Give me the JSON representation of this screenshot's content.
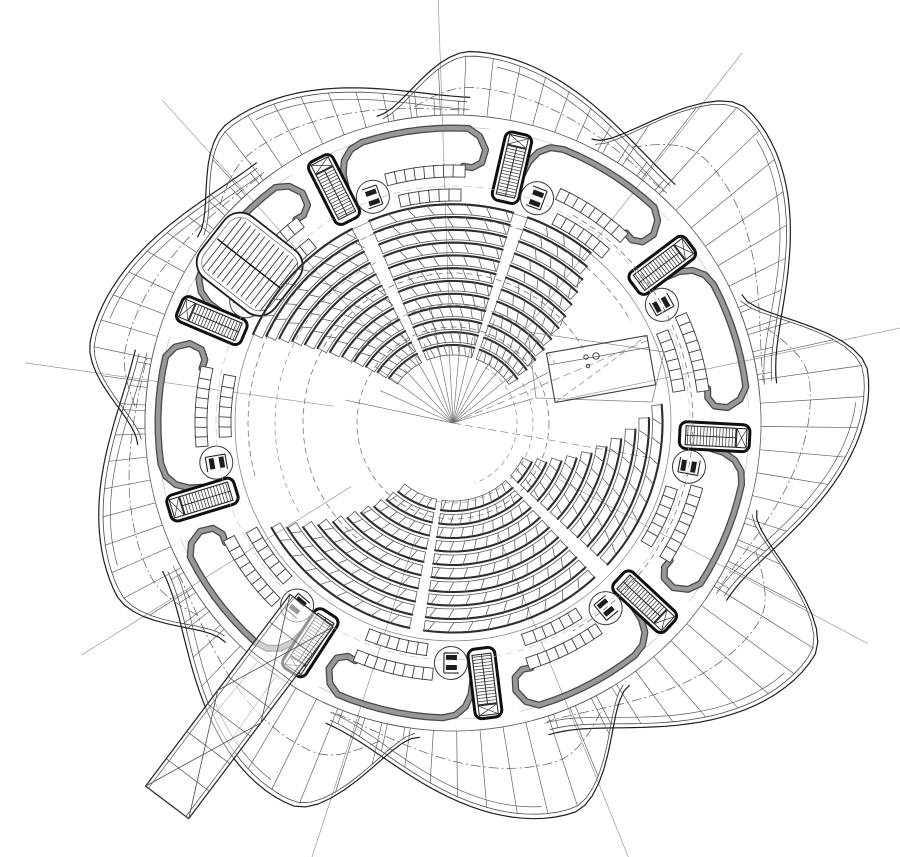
{
  "meta": {
    "title": "Circular auditorium floor plan",
    "description": "Nine-segment radial auditorium plan: petal envelope, perimeter stair cores, lift circles, corridor walls, spiral seating banks, rostrum, main stair and entry ramp"
  },
  "canvas": {
    "width": 900,
    "height": 857,
    "background": "#ffffff"
  },
  "colors": {
    "ink": "#1f1f1f",
    "medium": "#4a4a4a",
    "line": "#5a5a5a",
    "light": "#9a9a9a",
    "faint": "#b9b9b9",
    "wall_fill": "#989898",
    "wall_edge": "#4a4a4a",
    "seat_heavy": "#2d2d2d",
    "white": "#ffffff"
  },
  "plan": {
    "center": {
      "x": 453,
      "y": 423
    },
    "segments": 9,
    "base_angle_deg": 3,
    "step_deg": 40,
    "inner_ring_r": 308,
    "corridor_arc_r": 296,
    "floor_circle_r": 218,
    "petal": {
      "rise_start_deg": -27,
      "apex_deg": -10,
      "fall_end_deg": 30,
      "base_r": 316,
      "end_r": 326,
      "apex_r": [
        418,
        430,
        408,
        415,
        378,
        372,
        375,
        372,
        430
      ],
      "panel_step_deg": 4.33,
      "double_offset": 4.5
    },
    "wall": {
      "arc_r": 295,
      "arc_start_deg": 9,
      "arc_end_deg": 30,
      "stub": [
        [
          2.5,
          256
        ],
        [
          3.2,
          272
        ],
        [
          4.5,
          284
        ],
        [
          6.5,
          292
        ]
      ],
      "hook": [
        [
          32.3,
          288
        ],
        [
          33.8,
          275
        ],
        [
          33.3,
          262
        ],
        [
          31.3,
          256
        ],
        [
          29.3,
          257
        ]
      ],
      "outer_w": 7,
      "inner_w": 4.4
    },
    "core": {
      "r": 262,
      "len": 70,
      "wid": 27
    },
    "lift": {
      "angle_offset_deg": 7.5,
      "r": 240,
      "radius": 16.5
    },
    "gallery": [
      {
        "r": 252,
        "from_deg": 13,
        "to_deg": 29,
        "step_deg": 2.2,
        "size": 12
      },
      {
        "r": 228,
        "from_deg": 15,
        "to_deg": 27.5,
        "step_deg": 2.5,
        "size": 12
      }
    ],
    "boundary_line": {
      "angle_offset_deg": -15,
      "r0": 120,
      "r1": 470
    }
  },
  "stair_main": {
    "angle_deg": 218,
    "r": 258,
    "length": 94,
    "width": 78,
    "tread_step": 6
  },
  "ramp": {
    "angle_deg": 127,
    "r0": 235,
    "r1": 475,
    "half_width": 27,
    "rungs": 6
  },
  "rostrum": {
    "cx": 601,
    "cy": 369,
    "w": 102,
    "h": 50,
    "rot_deg": -10,
    "dots": [
      [
        586,
        357,
        2.2
      ],
      [
        596,
        356,
        3.2
      ],
      [
        588,
        366,
        1.8
      ]
    ],
    "platform": [
      [
        528,
        332
      ],
      [
        664,
        352
      ],
      [
        652,
        402
      ],
      [
        536,
        398
      ]
    ]
  },
  "seating": {
    "upper": {
      "rows": 12,
      "r0": 78,
      "dr": 12.8,
      "band": 10,
      "s_base": 204,
      "s_spread": 1.0,
      "e_base": 309,
      "e_spread": 1.5,
      "aisles": [
        [
          245,
          5
        ],
        [
          288,
          4
        ]
      ],
      "tick_deg": 5.2,
      "tick_slant_deg": 1.8
    },
    "lower": {
      "rows": 10,
      "r0": 88,
      "dr": 13.5,
      "band": 10,
      "s_base": -5,
      "s_spread": 3.5,
      "e_base": 150,
      "e_spread": -2.4,
      "aisles": [
        [
          45,
          5
        ],
        [
          100,
          4
        ]
      ],
      "tick_deg": 5.5,
      "tick_slant_deg": -1.8
    }
  },
  "construction": {
    "dashed_circles": [
      {
        "r": 96,
        "a0": 0,
        "a1": 360
      },
      {
        "r": 150,
        "a0": 130,
        "a1": 330
      },
      {
        "r": 205,
        "a0": 165,
        "a1": 330
      },
      {
        "r": 240,
        "a0": 300,
        "a1": 420
      }
    ],
    "spiral_arcs": [
      {
        "r": 64,
        "a0": 300,
        "a1": 430
      },
      {
        "r": 80,
        "a0": 330,
        "a1": 470
      },
      {
        "r": 118,
        "a0": 210,
        "a1": 330
      },
      {
        "r": 178,
        "a0": 150,
        "a1": 245
      }
    ],
    "spokes": [
      192,
      204,
      216,
      228,
      240,
      250,
      259,
      267,
      275,
      283,
      292,
      301,
      311,
      321,
      332,
      343
    ],
    "spoke_len": [
      110,
      80,
      95,
      72,
      105,
      85,
      115,
      78,
      100,
      88,
      112,
      80,
      96,
      75,
      108,
      84
    ],
    "long_radials": [
      {
        "a": 337,
        "r1": 215
      },
      {
        "a": 10,
        "r1": 205
      }
    ]
  }
}
